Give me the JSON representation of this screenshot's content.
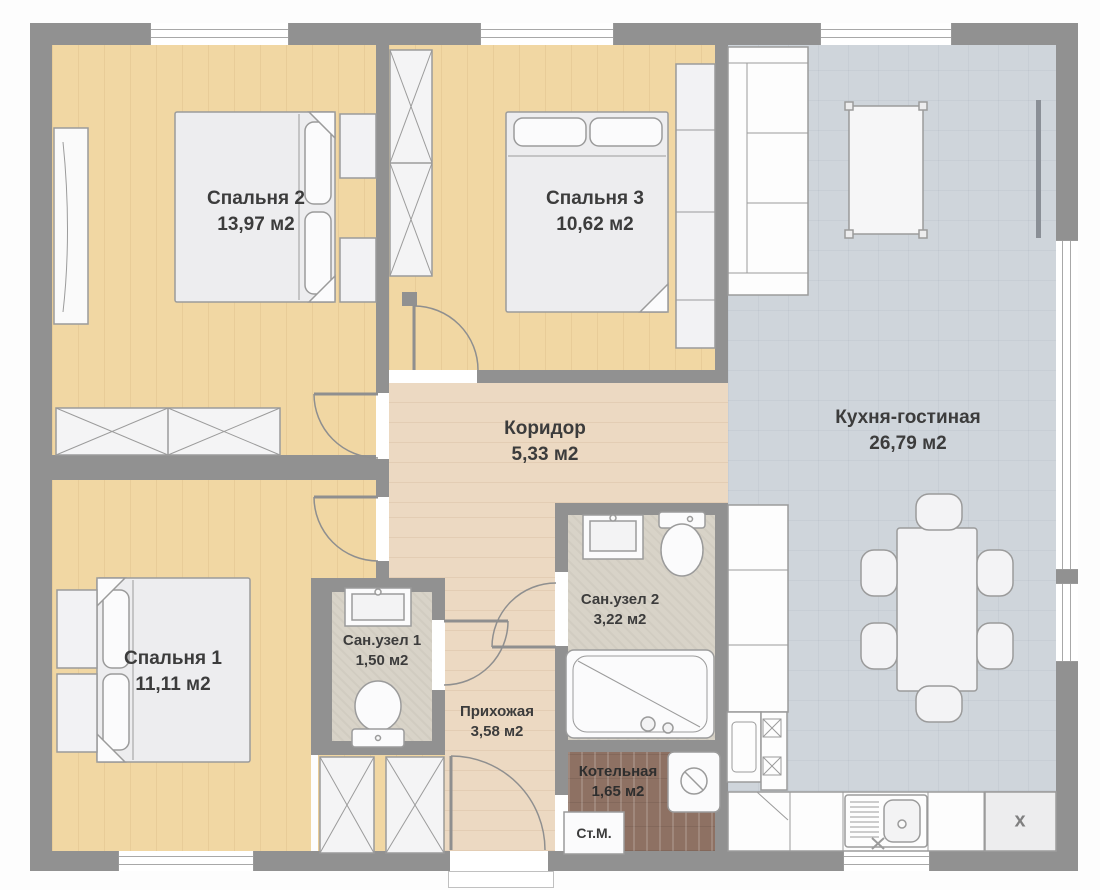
{
  "plan_title": "floor-plan",
  "rooms": [
    {
      "key": "bedroom2",
      "name": "Спальня 2",
      "area": "13,97 м2"
    },
    {
      "key": "bedroom3",
      "name": "Спальня 3",
      "area": "10,62 м2"
    },
    {
      "key": "kitchen_living",
      "name": "Кухня-гостиная",
      "area": "26,79 м2"
    },
    {
      "key": "corridor",
      "name": "Коридор",
      "area": "5,33 м2"
    },
    {
      "key": "bedroom1",
      "name": "Спальня 1",
      "area": "11,11 м2"
    },
    {
      "key": "bath1",
      "name": "Сан.узел 1",
      "area": "1,50 м2"
    },
    {
      "key": "bath2",
      "name": "Сан.узел 2",
      "area": "3,22 м2"
    },
    {
      "key": "hallway",
      "name": "Прихожая",
      "area": "3,58 м2"
    },
    {
      "key": "boiler",
      "name": "Котельная",
      "area": "1,65 м2"
    }
  ],
  "appliances": {
    "washing_machine": "Ст.М.",
    "reserved_unit": "x"
  },
  "palette": {
    "wall": "#919191",
    "bedroom_floor": "#f1d7a3",
    "corridor_floor": "#ecd9c2",
    "kitchen_floor": "#cfd5db",
    "bath_floor": "#d8d3c8",
    "boiler_floor": "#8e7163",
    "furniture": "#fafafa",
    "text": "#3c3c3c"
  }
}
